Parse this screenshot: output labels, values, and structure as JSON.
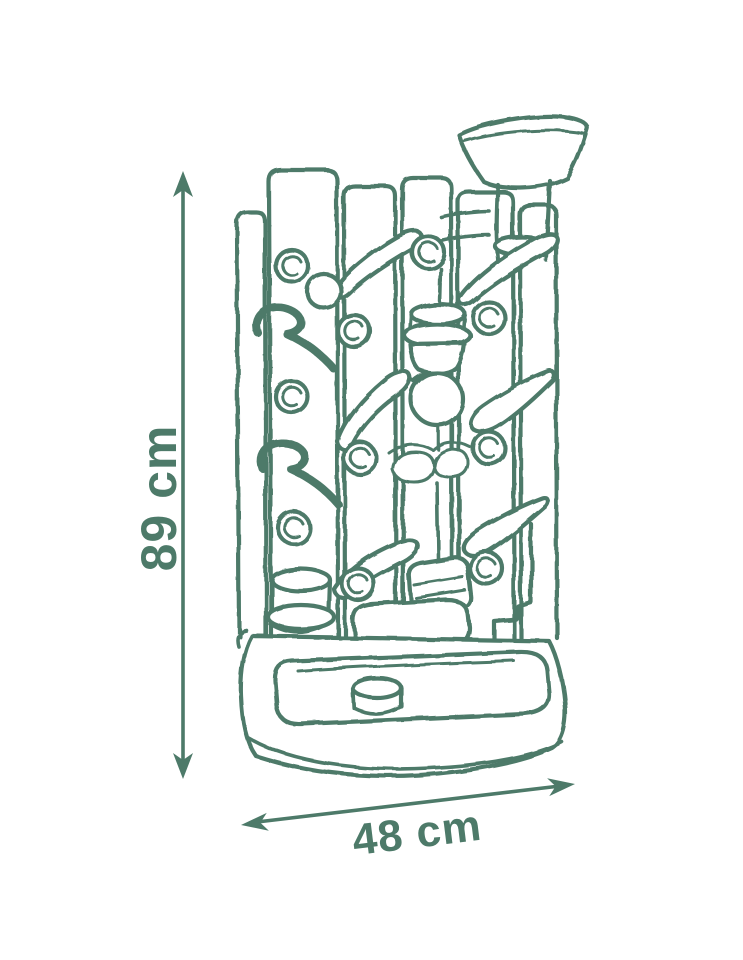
{
  "diagram": {
    "sketch_description": "Hand-drawn line sketch of a marble-run tower toy: top funnel, slatted wall with pegs, ramps, cups, balls and a basin base",
    "ink_color": "#4d7a69",
    "background_color": "#ffffff",
    "dimensions": {
      "height": {
        "label": "89 cm"
      },
      "width": {
        "label": "48 cm"
      }
    }
  }
}
